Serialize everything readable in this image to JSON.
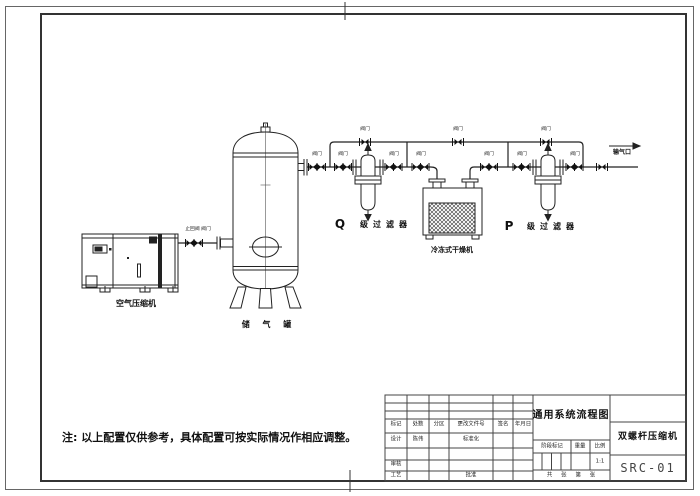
{
  "diagram": {
    "note": "注: 以上配置仅供参考，具体配置可按实际情况作相应调整。",
    "components": {
      "compressor": "空气压缩机",
      "tank": "储 气 罐",
      "dryer": "冷冻式干燥机",
      "q_prefix": "Q",
      "q_filter": "级过滤器",
      "p_prefix": "P",
      "p_filter": "级过滤器",
      "outlet": "输气口",
      "valve": "阀门",
      "check_valve_line": "止回阀 阀门"
    }
  },
  "title_block": {
    "title": "通用系统流程图",
    "product_name": "双螺杆压缩机",
    "drawing_number": "SRC-01",
    "revision_headers": [
      "标记",
      "处数",
      "分区",
      "更改文件号",
      "签名",
      "年月日"
    ],
    "design_label": "设计",
    "designer_name": "陈伟",
    "standardization_label": "标准化",
    "review_label": "审核",
    "process_label": "工艺",
    "approval_label": "批准",
    "stage_mark_label": "阶段标记",
    "weight_label": "重量",
    "scale_label": "比例",
    "scale_value": "1:1",
    "sheet_info": "共 张 第 张"
  }
}
